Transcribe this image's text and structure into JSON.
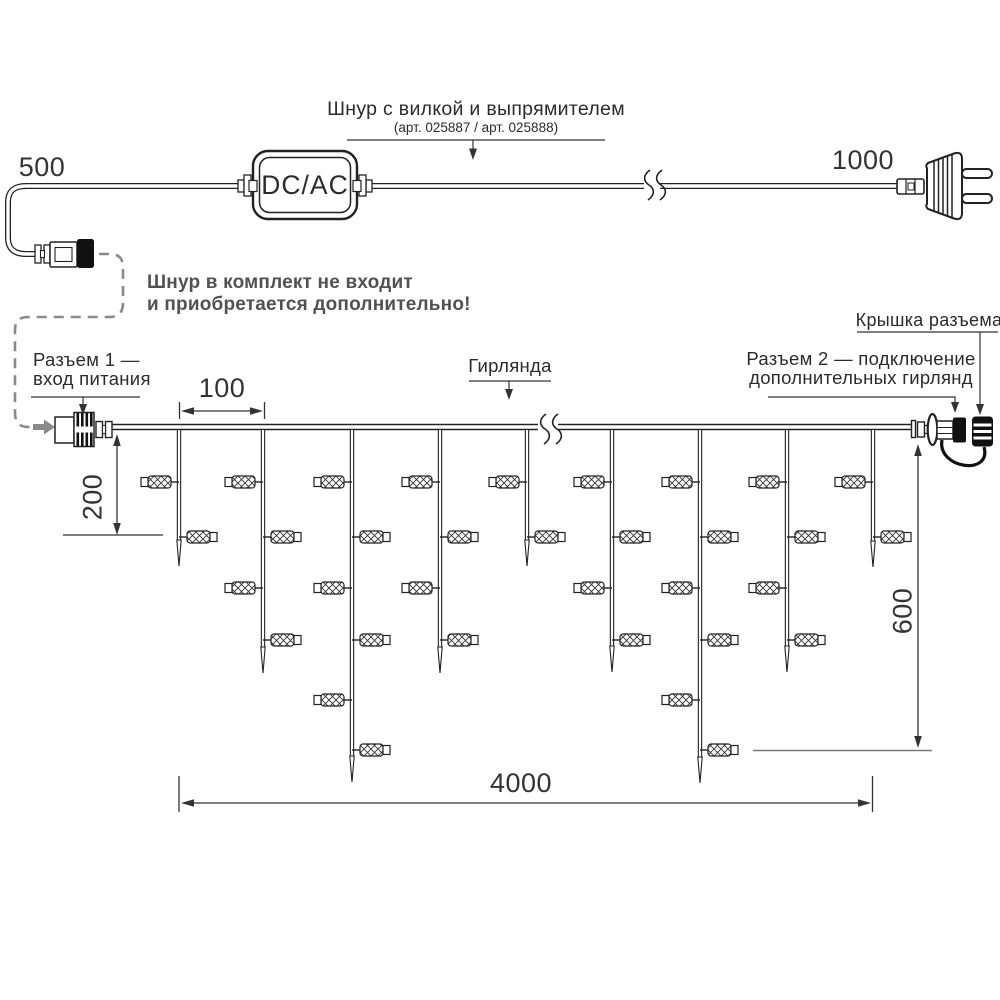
{
  "colors": {
    "line": "#222222",
    "dim": "#333333",
    "gray_dash": "#8a8a8a",
    "note_text": "#515151",
    "black_fill": "#111111"
  },
  "power_cord": {
    "length_left": "500",
    "length_right": "1000",
    "adapter_label": "DC/AC",
    "cord_label": "Шнур с вилкой и выпрямителем",
    "cord_sublabel": "(арт. 025887 / арт. 025888)",
    "note_line1": "Шнур в комплект не входит",
    "note_line2": "и приобретается дополнительно!"
  },
  "garland": {
    "connector1_label_line1": "Разъем 1 —",
    "connector1_label_line2": "вход питания",
    "garland_label": "Гирлянда",
    "cap_label": "Крышка разъема",
    "connector2_label_line1": "Разъем 2 — подключение",
    "connector2_label_line2": "дополнительных гирлянд",
    "dim_spacing": "100",
    "dim_first_drop": "200",
    "dim_height": "600",
    "dim_length": "4000",
    "geometry": {
      "wire_y": 427,
      "lamp_rows": [
        482,
        537,
        588,
        640,
        700,
        750
      ],
      "drops": [
        {
          "x": 179,
          "tip": 566,
          "lamps": 2
        },
        {
          "x": 263,
          "tip": 673,
          "lamps": 4
        },
        {
          "x": 352,
          "tip": 782,
          "lamps": 6
        },
        {
          "x": 440,
          "tip": 673,
          "lamps": 4
        },
        {
          "x": 527,
          "tip": 566,
          "lamps": 2
        },
        {
          "x": 612,
          "tip": 672,
          "lamps": 4
        },
        {
          "x": 700,
          "tip": 783,
          "lamps": 6
        },
        {
          "x": 787,
          "tip": 672,
          "lamps": 4
        },
        {
          "x": 873,
          "tip": 567,
          "lamps": 2
        }
      ]
    }
  }
}
